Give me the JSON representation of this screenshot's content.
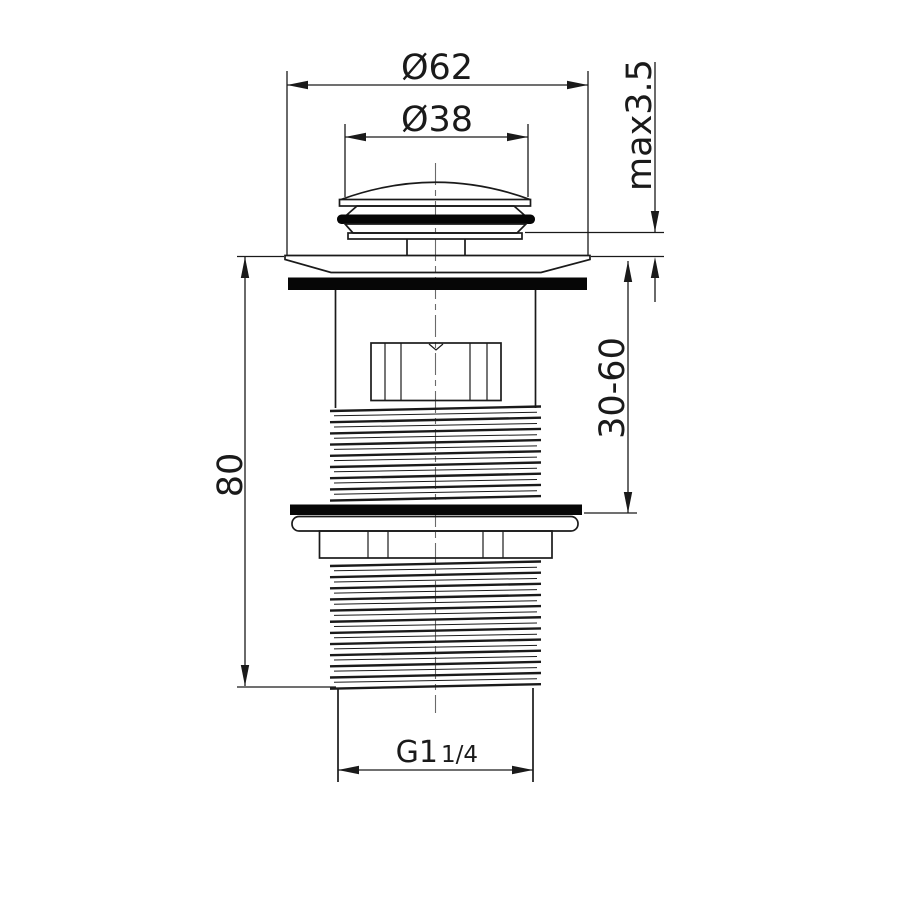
{
  "drawing": {
    "dimensions": {
      "outer_flange_diameter": "Ø62",
      "cap_diameter": "Ø38",
      "max_deck_thickness": "max3.5",
      "clamping_range": "30-60",
      "body_length": "80",
      "thread_size_main": "G1",
      "thread_size_fraction": "1/4"
    },
    "colors": {
      "line": "#1a1a1a",
      "gasket": "#060606",
      "background": "#ffffff"
    }
  }
}
